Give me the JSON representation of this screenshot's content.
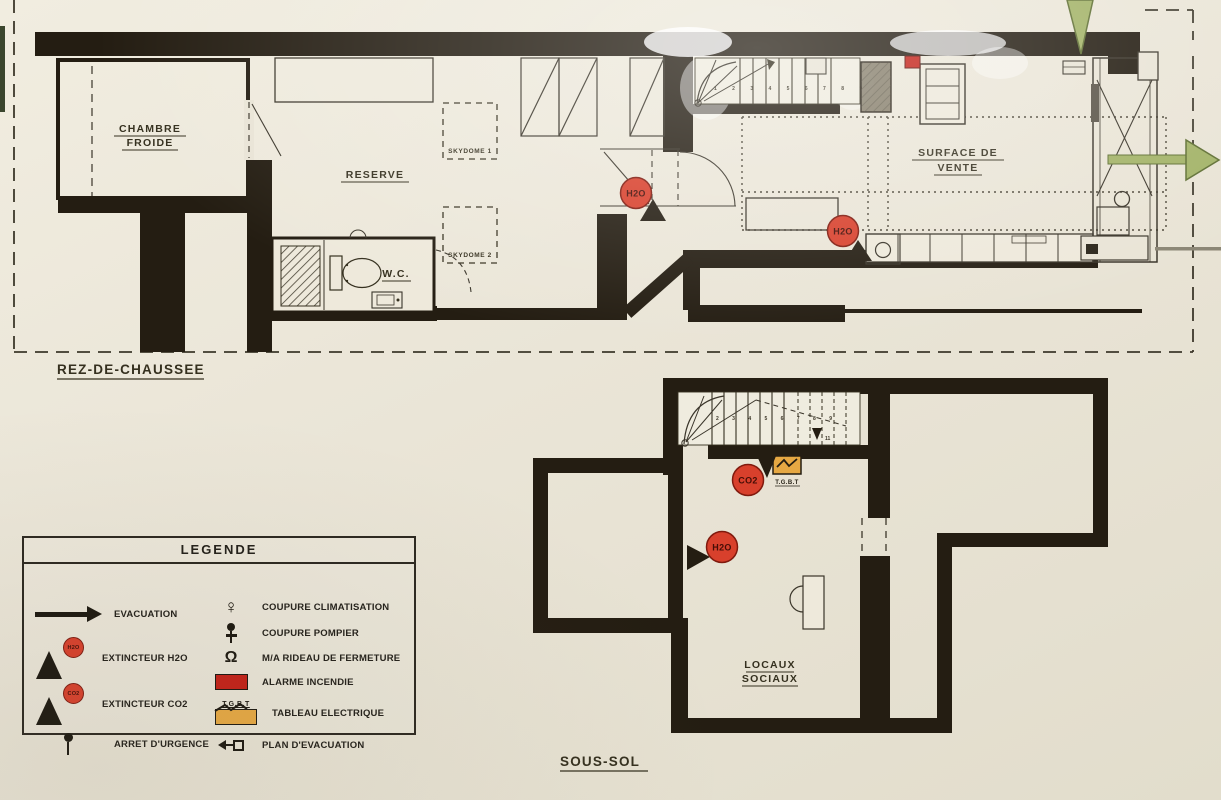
{
  "colors": {
    "background": "#eae5d7",
    "wall": "#241d12",
    "marker_red": "#d8402c",
    "marker_text": "#450d06",
    "evacuation_green": "#a3b368",
    "evacuation_green_border": "#5f6f33",
    "tgbt_orange": "#e6a843",
    "alarm_red": "#c32017"
  },
  "ground_floor": {
    "title": "REZ-DE-CHAUSSEE",
    "labels": {
      "chambre_froide": [
        "CHAMBRE",
        "FROIDE"
      ],
      "reserve": "RESERVE",
      "skydome_1": "SKYDOME 1",
      "skydome_2": "SKYDOME 2",
      "wc": "W.C.",
      "surface_de_vente": [
        "SURFACE DE",
        "VENTE"
      ],
      "stair_numbers": "1 2 3 4 5 6 7 8 9"
    },
    "markers": {
      "h2o_corridor": "H2O",
      "h2o_sales": "H2O"
    }
  },
  "basement": {
    "title": "SOUS-SOL",
    "labels": {
      "locaux_sociaux": [
        "LOCAUX",
        "SOCIAUX"
      ],
      "tgbt": "T.G.B.T",
      "stair_numbers": "2 3 4 5 6 7 8 9",
      "stair_end": "11"
    },
    "markers": {
      "h2o": "H2O",
      "co2": "CO2"
    }
  },
  "legend": {
    "title": "LEGENDE",
    "left": [
      {
        "id": "evacuation",
        "label": "EVACUATION"
      },
      {
        "id": "extincteur-h2o",
        "label": "EXTINCTEUR H2O",
        "badge": "H2O"
      },
      {
        "id": "extincteur-co2",
        "label": "EXTINCTEUR CO2",
        "badge": "CO2"
      },
      {
        "id": "arret-urgence",
        "label": "ARRET D'URGENCE"
      }
    ],
    "right": [
      {
        "id": "coupure-climatisation",
        "label": "COUPURE CLIMATISATION",
        "glyph": "♀"
      },
      {
        "id": "coupure-pompier",
        "label": "COUPURE POMPIER"
      },
      {
        "id": "rideau-fermeture",
        "label": "M/A RIDEAU DE FERMETURE",
        "glyph": "Ω"
      },
      {
        "id": "alarme-incendie",
        "label": "ALARME INCENDIE"
      },
      {
        "id": "tableau-electrique",
        "label": "TABLEAU ELECTRIQUE",
        "caption": "T.G.B.T"
      },
      {
        "id": "plan-evacuation",
        "label": "PLAN D'EVACUATION"
      }
    ]
  }
}
